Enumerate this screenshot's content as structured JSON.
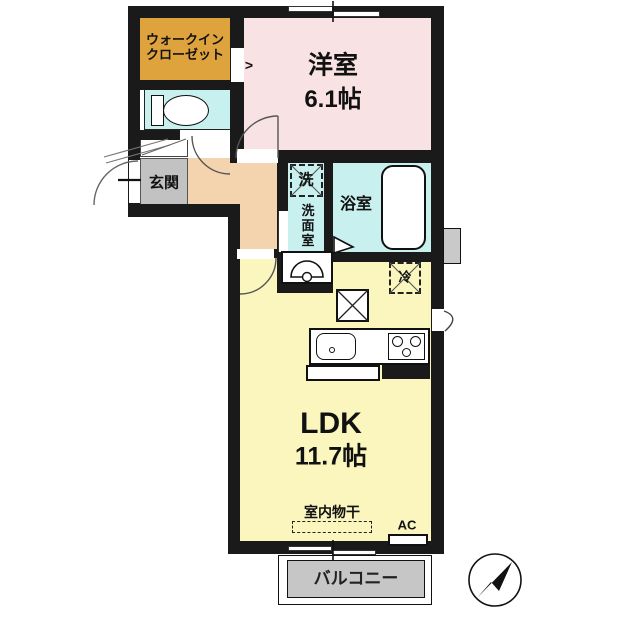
{
  "colors": {
    "wall": "#1a1a1a",
    "wic": "#dfa33e",
    "western": "#f9e2e4",
    "water": "#c8f0ee",
    "hallway": "#f4d4ae",
    "entrance": "#c2c2c2",
    "ldk": "#faf6be",
    "balcony": "#c6c6c6"
  },
  "rooms": {
    "wic_line1": "ウォークイン",
    "wic_line2": "クローゼット",
    "western_label": "洋室",
    "western_size": "6.1帖",
    "entrance_label": "玄関",
    "washroom_label": "洗面室",
    "washer_label": "洗",
    "bathroom_label": "浴室",
    "refrigerator_label": "冷",
    "ldk_label": "LDK",
    "ldk_size": "11.7帖",
    "drying_label": "室内物干",
    "ac_label": "AC",
    "balcony_label": "バルコニー",
    "wic_door_symbol": ">"
  }
}
